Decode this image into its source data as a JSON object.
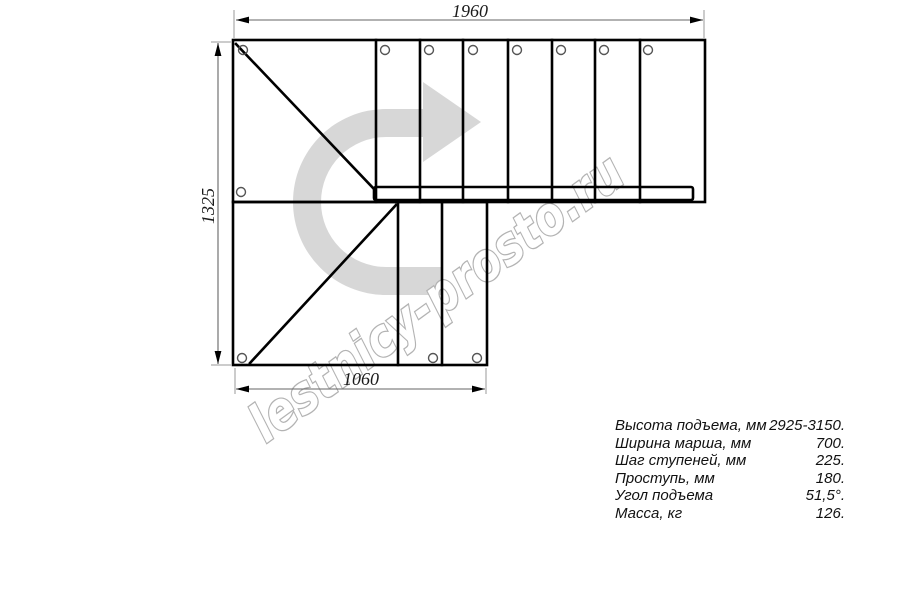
{
  "drawing": {
    "type": "l-shaped-staircase-plan",
    "dimensions": {
      "top_width": "1960",
      "left_height": "1325",
      "bottom_width": "1060"
    },
    "watermark": {
      "text": "lestnicy-prosto.ru"
    },
    "colors": {
      "direction_arrow": "#d7d7d7",
      "watermark_outline": "#b3b3b3",
      "line": "#000000",
      "dimension_line": "#666666",
      "extension_line": "#999999"
    }
  },
  "specs": {
    "rows": [
      {
        "label": "Высота подъема, мм",
        "value": "2925-3150."
      },
      {
        "label": "Ширина марша, мм",
        "value": "700."
      },
      {
        "label": "Шаг ступеней, мм",
        "value": "225."
      },
      {
        "label": "Проступь, мм",
        "value": "180."
      },
      {
        "label": "Угол подъема",
        "value": "51,5°."
      },
      {
        "label": "Масса, кг",
        "value": "126."
      }
    ]
  }
}
